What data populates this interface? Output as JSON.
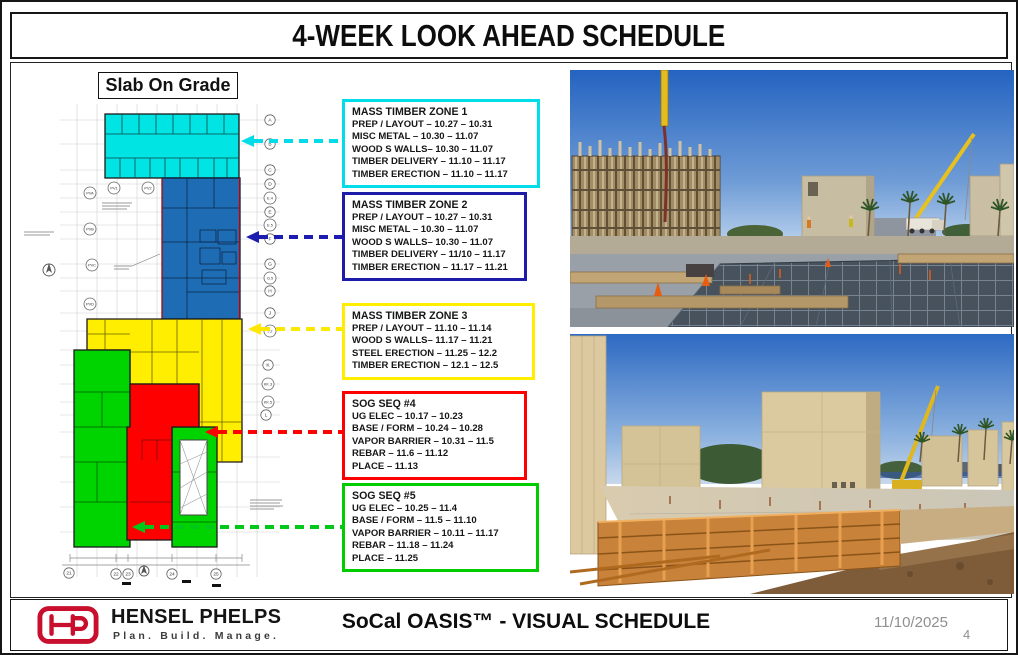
{
  "title": "4-WEEK LOOK AHEAD SCHEDULE",
  "plan": {
    "heading": "Slab On Grade",
    "grid_labels_right": [
      "A",
      "B",
      "C",
      "D",
      "E.4",
      "E",
      "E.5",
      "F",
      "G",
      "G.5",
      "H",
      "J",
      "J.2",
      "K",
      "KK.3",
      "KK.5",
      "L"
    ],
    "grid_labels_left": [
      "PVA",
      "PVB",
      "PVC",
      "PVD"
    ],
    "grid_labels_top": [
      "PV1",
      "PV2"
    ],
    "grid_labels_bottom": [
      "21",
      "22",
      "23",
      "24",
      "25"
    ],
    "zone_colors": {
      "mass_timber_zone_1": "#00e4e4",
      "mass_timber_zone_2": "#1e6cb4",
      "mass_timber_zone_3": "#ffee00",
      "sog_seq_4": "#fe0000",
      "sog_seq_5": "#00d400"
    }
  },
  "schedule_boxes": [
    {
      "title": "MASS TIMBER ZONE 1",
      "border_color": "#00dce8",
      "lines": [
        "PREP / LAYOUT – 10.27 – 10.31",
        "MISC METAL – 10.30 – 11.07",
        "WOOD S WALLS– 10.30 – 11.07",
        "TIMBER DELIVERY – 11.10 – 11.17",
        "TIMBER ERECTION – 11.10 – 11.17"
      ]
    },
    {
      "title": "MASS TIMBER ZONE 2",
      "border_color": "#1c1ca8",
      "lines": [
        "PREP / LAYOUT – 10.27 – 10.31",
        "MISC METAL – 10.30 – 11.07",
        "WOOD S WALLS– 10.30 – 11.07",
        "TIMBER DELIVERY – 11/10 – 11.17",
        "TIMBER ERECTION – 11.17 – 11.21"
      ]
    },
    {
      "title": "MASS TIMBER ZONE 3",
      "border_color": "#ffee00",
      "lines": [
        "PREP / LAYOUT – 11.10 – 11.14",
        "WOOD S WALLS– 11.17 – 11.21",
        "STEEL ERECTION – 11.25 – 12.2",
        "TIMBER ERECTION – 12.1 – 12.5"
      ]
    },
    {
      "title": "SOG SEQ #4",
      "border_color": "#fe0000",
      "lines": [
        "UG ELEC – 10.17 – 10.23",
        "BASE / FORM – 10.24 – 10.28",
        "VAPOR BARRIER – 10.31 – 11.5",
        "REBAR – 11.6 – 11.12",
        "PLACE – 11.13"
      ]
    },
    {
      "title": "SOG SEQ #5",
      "border_color": "#00cd00",
      "lines": [
        "UG ELEC – 10.25 – 11.4",
        "BASE / FORM – 11.5 – 11.10",
        "VAPOR BARRIER – 10.11 – 11.17",
        "REBAR – 11.18 – 11.24",
        "PLACE – 11.25"
      ]
    }
  ],
  "footer": {
    "logo_monogram": "HP",
    "company": "HENSEL PHELPS",
    "tagline": "Plan. Build. Manage.",
    "project": "SoCal OASIS™ - VISUAL SCHEDULE",
    "date": "11/10/2025",
    "page": "4"
  }
}
